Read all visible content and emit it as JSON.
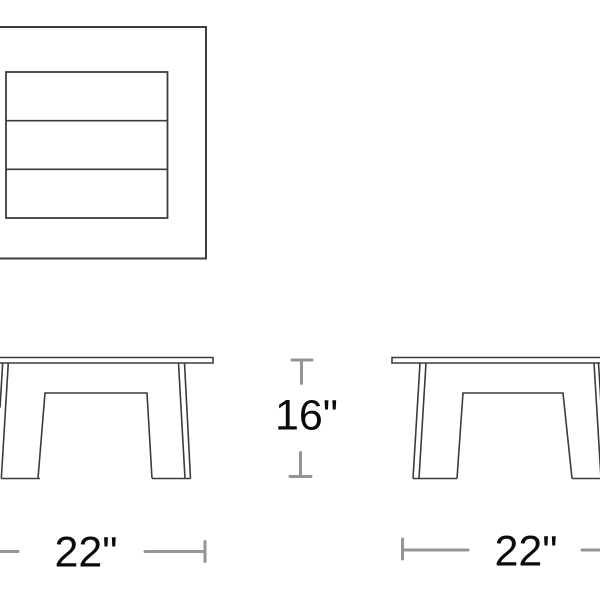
{
  "diagram": {
    "type": "furniture-dimension-drawing",
    "views": {
      "top_view": "table seen from above with three tabletop slats",
      "front_view_left": "table elevation, cropped at left edge",
      "front_view_right": "table elevation, cropped at right edge"
    },
    "colors": {
      "background": "#ffffff",
      "drawing_line": "#3c3c3c",
      "dimension_line": "#949494",
      "label_text": "#0a0a0a"
    }
  },
  "dimensions": {
    "height_label": "16\"",
    "width_left_label": "22\"",
    "width_right_label": "22\""
  }
}
